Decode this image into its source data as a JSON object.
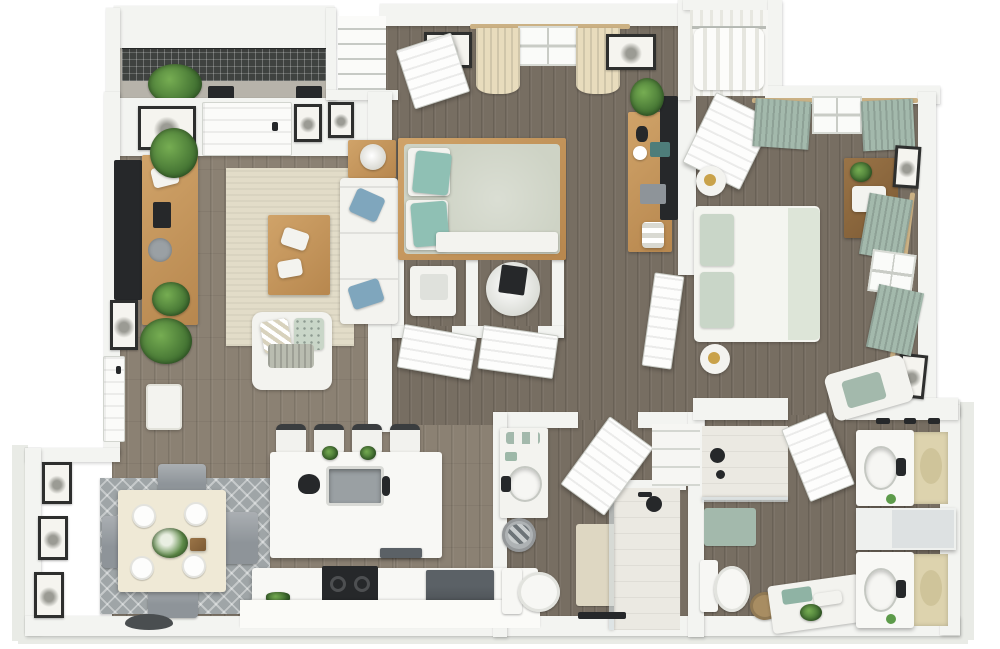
{
  "scene": {
    "title": "3D top-down floor plan rendering of a two-bedroom, two-bath apartment",
    "style": "photoreal dollhouse view, white walls, gray-brown plank flooring, white background"
  },
  "palette": {
    "wall": "#f3f4f1",
    "wood": "#8b8173",
    "woodDark": "#776e62",
    "concrete": "#b7b3aa",
    "railing": "#3f4240",
    "ground": "#e9ebe6",
    "rugBeige": "#e2dcc8",
    "rugGray": "#9fa5a7",
    "oak": "#c99b5f",
    "oakDark": "#8a6a42",
    "teal": "#8fc0b4",
    "sage": "#a3b9ac",
    "sageLight": "#c9d6c8",
    "creamCurtain": "#e8dcbd",
    "duvetGray": "#ced3c5",
    "marble": "#f8f8f5",
    "steel": "#5b6166",
    "charcoal": "#26282a",
    "plantDark": "#3f6e30",
    "plantLight": "#76ad52",
    "mirrorBeige": "#ddd3ae",
    "tile": "#ebe9e2",
    "rodTan": "#cbb184"
  },
  "rooms": [
    {
      "id": "balcony",
      "label": "Balcony",
      "furniture": [
        "metal grid railing",
        "concrete deck",
        "potted plants",
        "planter boxes"
      ]
    },
    {
      "id": "living-room",
      "label": "Living Room",
      "furniture": [
        "wall-mounted TV",
        "oak media console",
        "potted plants",
        "beige area rug",
        "oak coffee table with magazines",
        "white sofa with blue pillows",
        "side table with lamp",
        "white accent chair with pillows",
        "framed art",
        "entry door",
        "white doormat"
      ]
    },
    {
      "id": "dining-area",
      "label": "Dining Area",
      "furniture": [
        "square dining table",
        "four gray chairs",
        "four place settings",
        "flower centerpiece",
        "patterned gray rug",
        "three framed sketches"
      ]
    },
    {
      "id": "kitchen",
      "label": "Kitchen",
      "furniture": [
        "marble island with sink and faucet",
        "four bar stools",
        "black kettle",
        "herb pots",
        "dishwasher",
        "black range cooktop",
        "dark refrigerator",
        "white counter"
      ]
    },
    {
      "id": "bedroom-1",
      "label": "Bedroom 1",
      "furniture": [
        "queen bed with teal pillows",
        "cream curtains and window",
        "framed art",
        "oak desk with TV",
        "potted plant",
        "open entry door"
      ]
    },
    {
      "id": "bedroom-1-closet",
      "label": "Bedroom 1 Closet",
      "furniture": [
        "wire shelving"
      ]
    },
    {
      "id": "utility-closets",
      "label": "Utility Closets",
      "furniture": [
        "washer unit",
        "water heater",
        "two open louvered doors"
      ]
    },
    {
      "id": "hallway",
      "label": "Hallway",
      "furniture": []
    },
    {
      "id": "bathroom-1",
      "label": "Bathroom 1",
      "furniture": [
        "vanity with sink and towels",
        "towel basket",
        "toilet",
        "beige bath mat",
        "glass walk-in shower",
        "open door",
        "towel rack"
      ]
    },
    {
      "id": "linen-closet",
      "label": "Linen Closet",
      "furniture": [
        "white shelving"
      ]
    },
    {
      "id": "bedroom-2",
      "label": "Bedroom 2",
      "furniture": [
        "queen bed with sage pillows",
        "round nightstands with lamps",
        "dark wood dresser with radio",
        "sage curtains on two windows",
        "framed art",
        "accent chair with sage throw",
        "open doors"
      ]
    },
    {
      "id": "walk-in-closet",
      "label": "Walk-in Closet",
      "furniture": [
        "hanging white clothes on rod"
      ]
    },
    {
      "id": "bathroom-2",
      "label": "Bathroom 2 (ensuite)",
      "furniture": [
        "tiled shower with glass front",
        "sage bath mat",
        "toilet",
        "woven basket",
        "white bench with towels and plant",
        "two vanities with sinks and mirrors",
        "divider cabinet",
        "towel bars"
      ]
    }
  ]
}
